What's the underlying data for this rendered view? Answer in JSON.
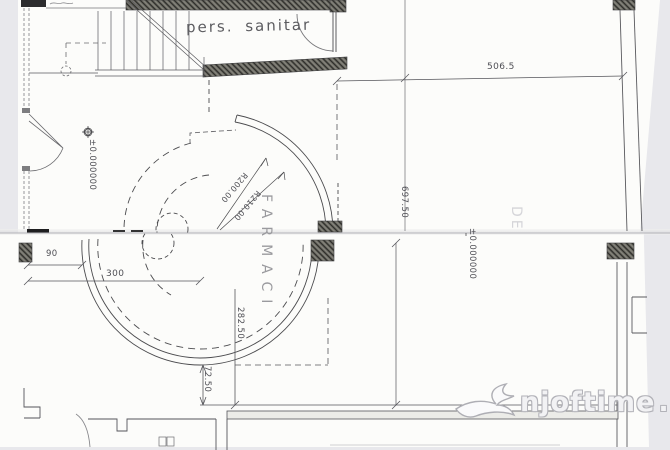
{
  "plan": {
    "room_label": "pers. sanitar",
    "area_label": "FARMACI",
    "faint_label": "DE"
  },
  "dimensions": {
    "width_top": "506.5",
    "height_right": "697.50",
    "height_mid": "282.50",
    "height_small": "72.50",
    "width_small": "90",
    "width_mid": "300",
    "radius_inner": "R200.00",
    "radius_outer": "R210.00",
    "level_left": "±0.000000",
    "level_right": "±0.000000"
  },
  "watermark": {
    "brand": "njoftime",
    "separator": ".",
    "tld": "al"
  },
  "colors": {
    "ink": "#4b4b4e",
    "wall_fill": "#504f4a",
    "paper": "#fcfcfa",
    "backdrop": "#e8e8ec",
    "watermark_gray": "#b2b2b8"
  }
}
